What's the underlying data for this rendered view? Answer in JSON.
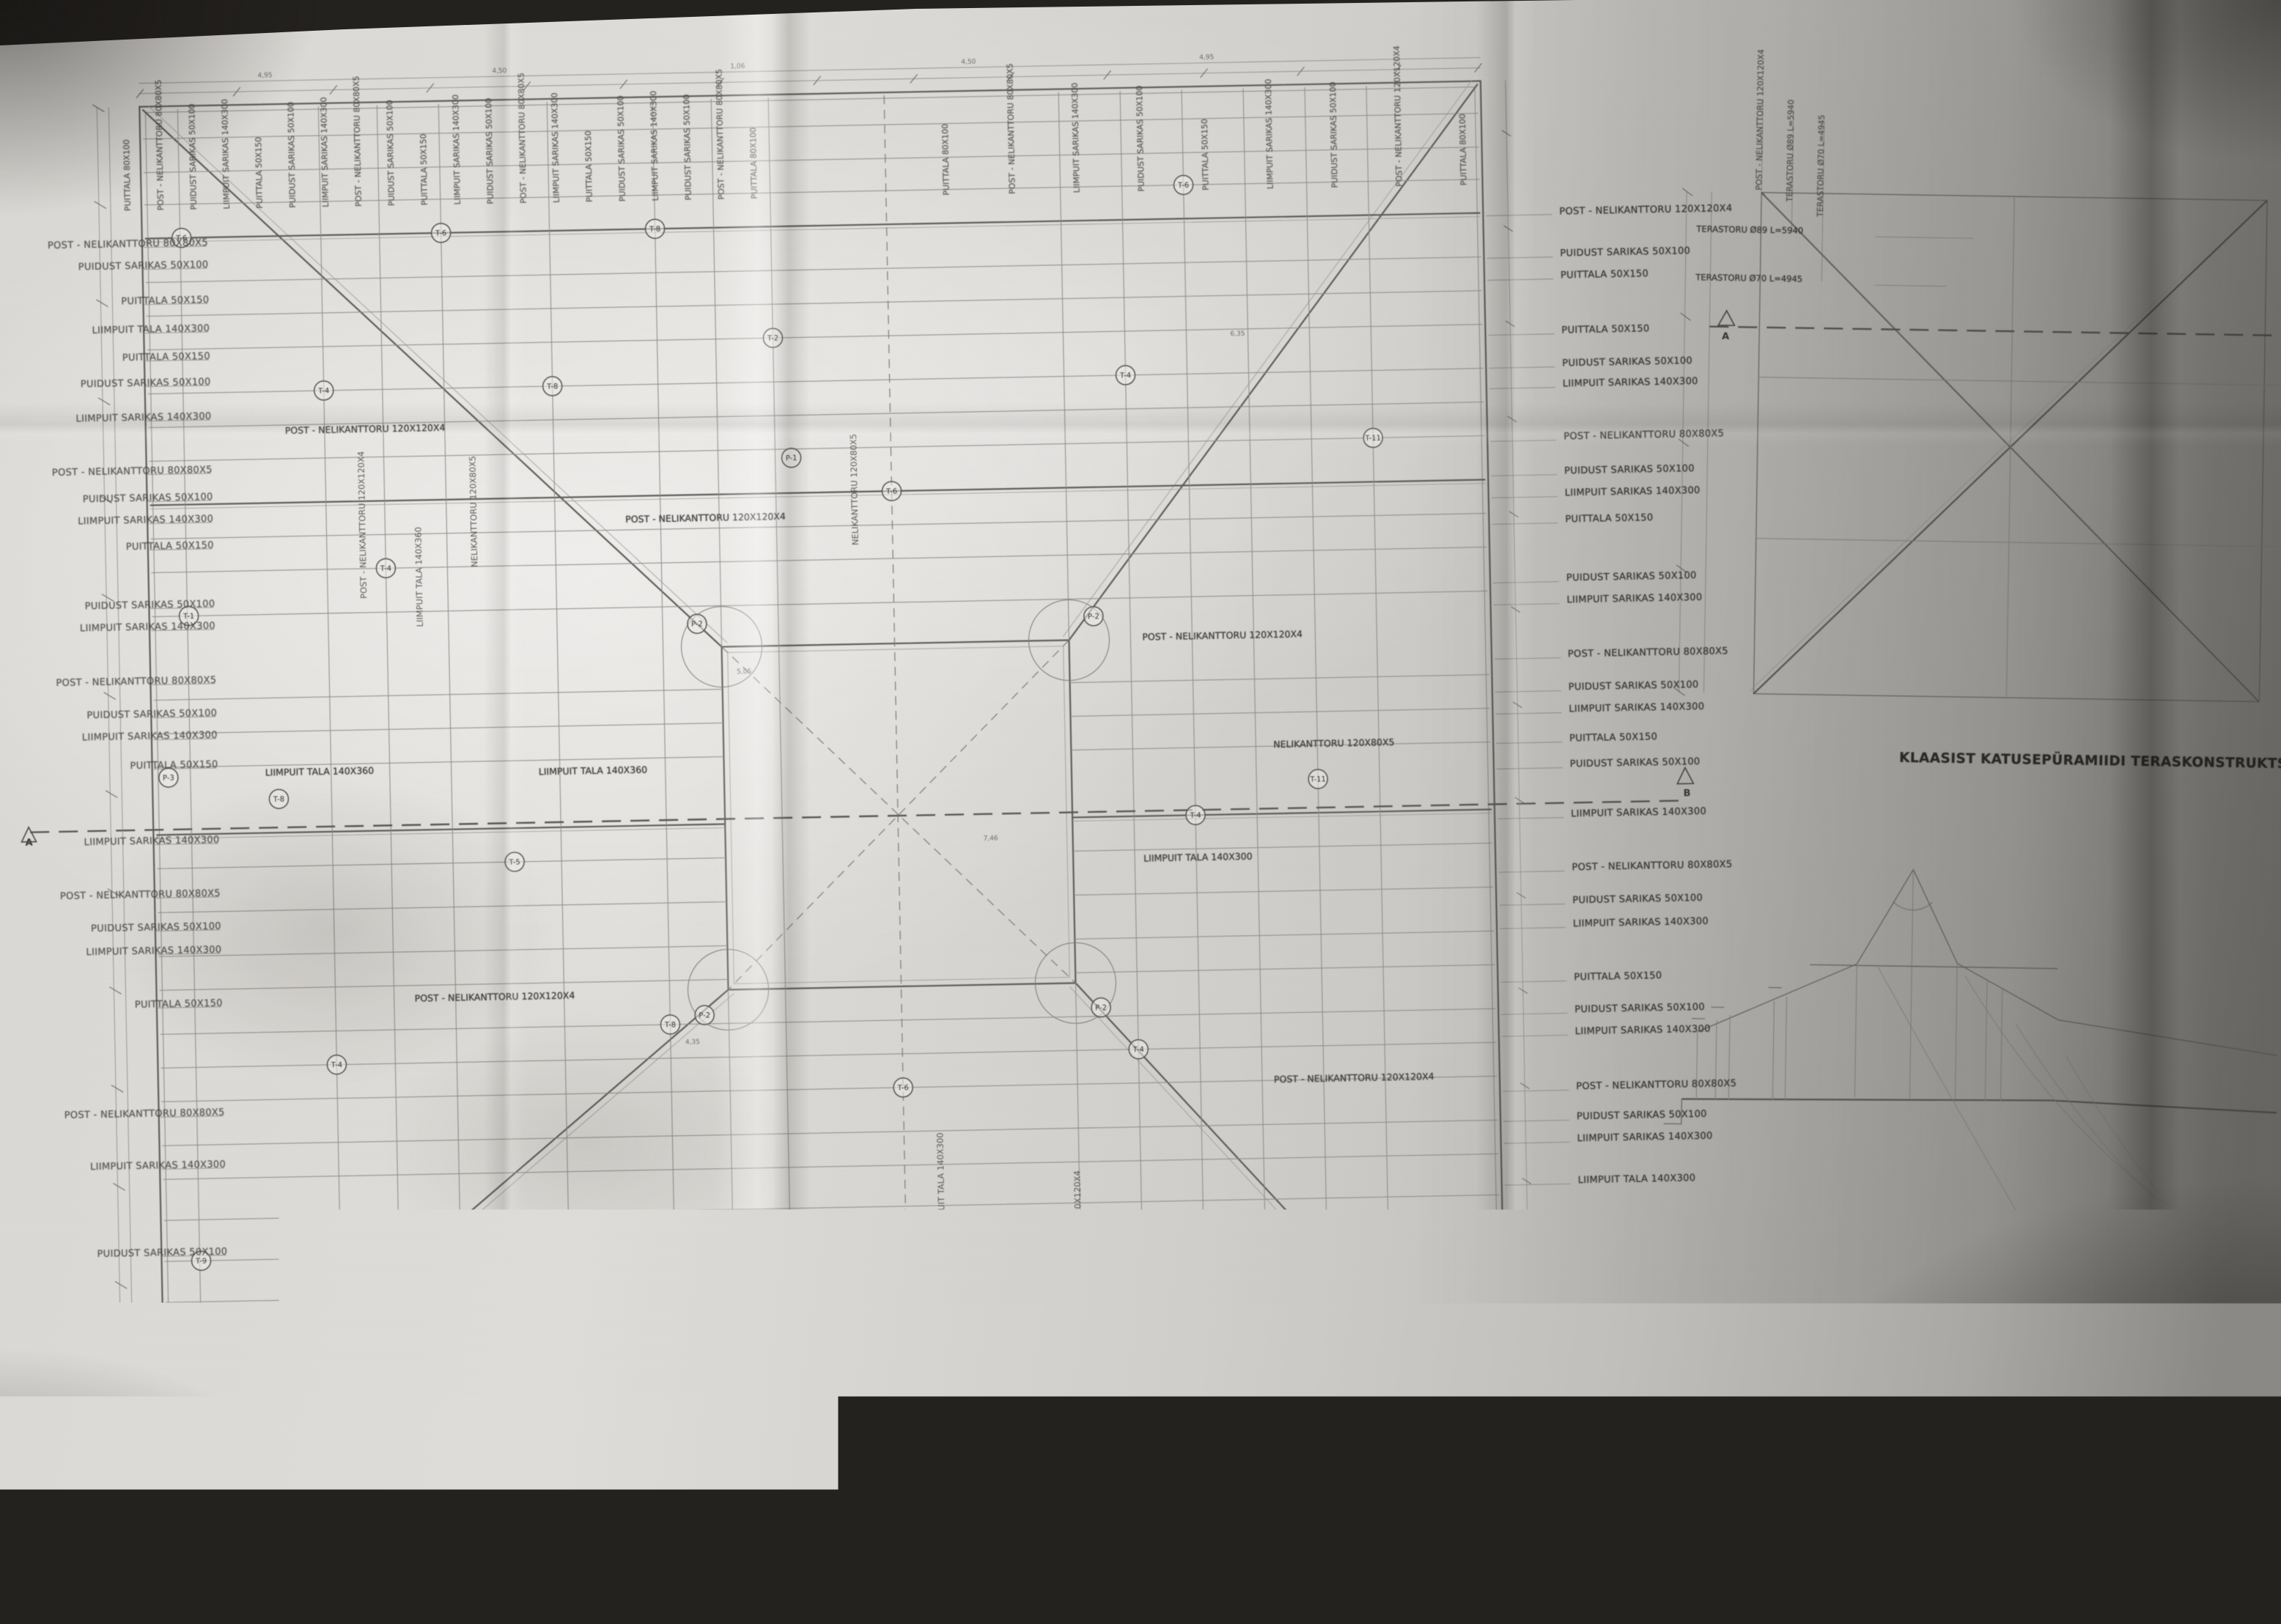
{
  "plan": {
    "section_a": "A",
    "section_b": "B",
    "interior_labels": [
      "POST - NELIKANTTORU 120X120X4",
      "POST - NELIKANTTORU 120X120X4",
      "POST - NELIKANTTORU 120X120X4",
      "LIIMPUIT TALA 140X360",
      "LIIMPUIT TALA 140X360",
      "LIIMPUIT TALA 140X300",
      "NELIKANTTORU 120X80X5",
      "POST - NELIKANTTORU 120X120X4",
      "POST - NELIKANTTORU 120X120X4"
    ],
    "vertical_labels": [
      "POST - NELIKANTTORU 120X120X4",
      "LIIMPUIT TALA 140X360",
      "NELIKANTTORU 120X80X5",
      "NELIKANTTORU 120X80X5",
      "LIIMPUIT TALA 140X300",
      "POST - NELIKANTTORU 120X120X4"
    ],
    "dims_top": [
      "4,95",
      "4,50",
      "1,06",
      "4,50",
      "4,95"
    ],
    "dims_inner": [
      "7,46",
      "5,05",
      "4,35",
      "6,35"
    ],
    "markers": [
      "T-6",
      "T-6",
      "T-8",
      "T-6",
      "T-4",
      "T-8",
      "T-2",
      "T-4",
      "T-1",
      "T-4",
      "T-6",
      "T-11",
      "T-8",
      "T-5",
      "T-4",
      "T-11",
      "T-4",
      "T-8",
      "T-6",
      "T-4",
      "T-9",
      "T-6",
      "T-8",
      "T-10",
      "T-3",
      "T-7",
      "P-2",
      "P-2",
      "P-2",
      "P-2",
      "P-1",
      "P-3"
    ]
  },
  "right_callouts": [
    "POST - NELIKANTTORU 120X120X4",
    "PUIDUST SARIKAS 50X100",
    "PUITTALA 50X150",
    "PUITTALA 50X150",
    "PUIDUST SARIKAS 50X100",
    "LIIMPUIT SARIKAS 140X300",
    "POST - NELIKANTTORU 80X80X5",
    "PUIDUST SARIKAS 50X100",
    "LIIMPUIT SARIKAS 140X300",
    "PUITTALA 50X150",
    "PUIDUST SARIKAS 50X100",
    "LIIMPUIT SARIKAS 140X300",
    "POST - NELIKANTTORU 80X80X5",
    "PUIDUST SARIKAS 50X100",
    "LIIMPUIT SARIKAS 140X300",
    "PUITTALA 50X150",
    "PUIDUST SARIKAS 50X100",
    "LIIMPUIT SARIKAS 140X300",
    "POST - NELIKANTTORU 80X80X5",
    "PUIDUST SARIKAS 50X100",
    "LIIMPUIT SARIKAS 140X300",
    "PUITTALA 50X150",
    "PUIDUST SARIKAS 50X100",
    "LIIMPUIT SARIKAS 140X300",
    "POST - NELIKANTTORU 80X80X5",
    "PUIDUST SARIKAS 50X100",
    "LIIMPUIT SARIKAS 140X300",
    "LIIMPUIT TALA 140X300",
    "PUIDUST SARIKAS 50X100",
    "LIIMPUIT SARIKAS 140X300",
    "PUITTALA 50X150",
    "POST - NELIKANTTORU 120X120X4",
    "PUIDUST SARIKAS 50X100",
    "PUITTALA 80X200"
  ],
  "left_callouts": [
    "POST - NELIKANTTORU 80X80X5",
    "PUIDUST SARIKAS 50X100",
    "PUITTALA 50X150",
    "LIIMPUIT TALA 140X300",
    "PUITTALA 50X150",
    "PUIDUST SARIKAS 50X100",
    "LIIMPUIT SARIKAS 140X300",
    "POST - NELIKANTTORU 80X80X5",
    "PUIDUST SARIKAS 50X100",
    "LIIMPUIT SARIKAS 140X300",
    "PUITTALA 50X150",
    "PUIDUST SARIKAS 50X100",
    "LIIMPUIT SARIKAS 140X300",
    "POST - NELIKANTTORU 80X80X5",
    "PUIDUST SARIKAS 50X100",
    "LIIMPUIT SARIKAS 140X300",
    "PUITTALA 50X150",
    "LIIMPUIT SARIKAS 140X300",
    "POST - NELIKANTTORU 80X80X5",
    "PUIDUST SARIKAS 50X100",
    "LIIMPUIT SARIKAS 140X300",
    "PUITTALA 50X150",
    "POST - NELIKANTTORU 80X80X5",
    "LIIMPUIT SARIKAS 140X300",
    "PUIDUST SARIKAS 50X100",
    "PUITTALA 50X150",
    "POST - NELIKANTTORU 80X80X5"
  ],
  "top_labels": [
    "PUITTALA 80X100",
    "POST - NELIKANTTORU 80X80X5",
    "PUIDUST SARIKAS 50X100",
    "LIIMPUIT SARIKAS 140X300",
    "PUITTALA 50X150",
    "PUIDUST SARIKAS 50X100",
    "LIIMPUIT SARIKAS 140X300",
    "POST - NELIKANTTORU 80X80X5",
    "PUIDUST SARIKAS 50X100",
    "PUITTALA 50X150",
    "LIIMPUIT SARIKAS 140X300",
    "PUIDUST SARIKAS 50X100",
    "POST - NELIKANTTORU 80X80X5",
    "LIIMPUIT SARIKAS 140X300",
    "PUITTALA 50X150",
    "PUIDUST SARIKAS 50X100",
    "LIIMPUIT SARIKAS 140X300",
    "PUIDUST SARIKAS 50X100",
    "POST - NELIKANTTORU 80X80X5",
    "PUITTALA 80X100",
    "PUITTALA 80X100",
    "POST - NELIKANTTORU 80X80X5",
    "LIIMPUIT SARIKAS 140X300",
    "PUIDUST SARIKAS 50X100",
    "PUITTALA 50X150",
    "LIIMPUIT SARIKAS 140X300",
    "PUIDUST SARIKAS 50X100",
    "POST - NELIKANTTORU 120X120X4",
    "PUITTALA 80X100"
  ],
  "bottom_labels": [
    "PUITTALA 80X200",
    "PUIDUST SARIKAS 50X100",
    "LIIMPUIT SARIKAS 140X300",
    "PUITTALA 50X150",
    "POST - NELIKANTTORU 80X80X5",
    "PUIDUST SARIKAS 50X100",
    "LIIMPUIT SARIKAS 140X300",
    "PUITTALA 50X150",
    "PUIDUST SARIKAS 50X100",
    "LIIMPUIT TALA 140X300",
    "POST - NELIKANTTORU 80X80X5",
    "PUIDUST SARIKAS 50X100",
    "LIIMPUIT SARIKAS 140X300",
    "PUITTALA 50X150",
    "PUIDUST SARIKAS 50X100",
    "POST - NELIKANTTORU 80X80X5",
    "LIIMPUIT SARIKAS 140X300",
    "PUITTALA 80X200"
  ],
  "detail": {
    "title": "KLAASIST KATUSEPÜRAMIIDI TERASKONSTRUKTSIOON",
    "rotated": [
      "POST - NELIKANTTORU 120X120X4",
      "TERASTORU Ø89 L=5940",
      "TERASTORU Ø70 L=4945"
    ],
    "callouts": [
      "TERASTORU Ø89 L=5940",
      "TERASTORU Ø70 L=4945"
    ],
    "marker": "A"
  },
  "section": {
    "title": "LÕIGE AB",
    "sep": "-",
    "scale": "M 1/100"
  },
  "tables": {
    "talade": {
      "title": "TALADE TABEL",
      "headers": [
        "TALA NUMBER",
        "MÕÕDUD mm",
        "L mm",
        "ARV"
      ],
      "rows": [
        [
          "T - 1",
          "140X300",
          "10800",
          "4"
        ],
        [
          "T - 2",
          "140X360",
          "6000",
          "4"
        ],
        [
          "T - 3",
          "140X300",
          "2595",
          "8"
        ],
        [
          "T - 4",
          "140X300",
          "4685",
          "8"
        ],
        [
          "T - 5",
          "140X300",
          "6775",
          "8"
        ],
        [
          "T - 6",
          "140X300",
          "7770",
          "12"
        ],
        [
          "T - 7",
          "80X200",
          "4710",
          "8"
        ],
        [
          "T - 8",
          "80X200",
          "4500",
          "12"
        ],
        [
          "T - 9",
          "50X100",
          "1180",
          "44"
        ],
        [
          "T - 10",
          "120X80X5",
          "4410",
          "8"
        ],
        [
          "T - 11",
          "120X80X5",
          "4000",
          "12"
        ]
      ]
    },
    "postide": {
      "title": "POSTIDE TABEL",
      "headers": [
        "POST NUMBER",
        "MÕÕDUD mm",
        "L mm"
      ],
      "rows": [
        [
          "P - 1",
          "80X80X5",
          ""
        ],
        [
          "P - 2",
          "120X120X4",
          ""
        ],
        [
          "P - 3",
          "120X120X4",
          ""
        ]
      ]
    }
  },
  "titleblock": {
    "fields": [
      {
        "label": "Tähis:",
        "value": "0703",
        "value2": ""
      },
      {
        "label": "Tellija:",
        "value": "Hr. Mart Laisk",
        "value2": ""
      },
      {
        "label": "Objekt:",
        "value": "ERAMU, Harjumaa",
        "value2": "Vatsla Küla, Sassi"
      },
      {
        "label": "Joonis:",
        "value": "KANDE KONSTRUKTSIOON",
        "value2": "M 1:50"
      }
    ]
  }
}
